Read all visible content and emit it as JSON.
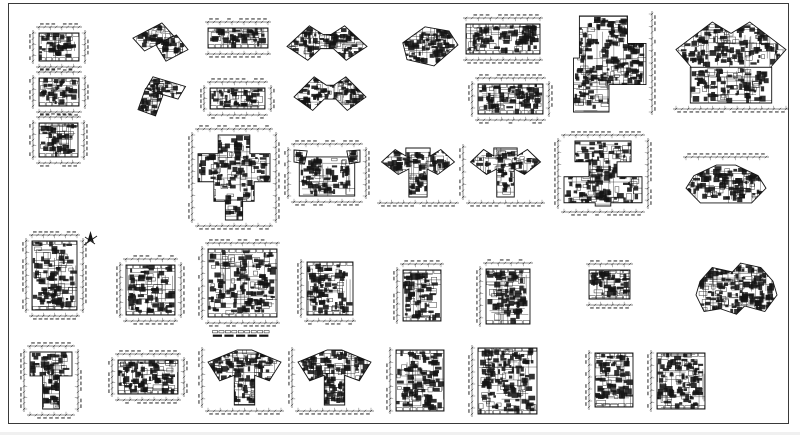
{
  "sheet": {
    "bg": "#ffffff",
    "ink": "#141414",
    "frame_color": "#3a3a3a",
    "frame": {
      "x": 8,
      "y": 3,
      "w": 781,
      "h": 421
    }
  },
  "north_arrow": {
    "x": 82,
    "y": 231,
    "size": 17
  },
  "caption_strip": {
    "x": 212,
    "y": 325,
    "w": 58,
    "row1_segments": 9,
    "row2_segments": 5
  },
  "plans": [
    {
      "id": "p01",
      "x": 30,
      "y": 24,
      "w": 58,
      "h": 46,
      "shape": "slab",
      "dims": "tblr",
      "density": 1.15
    },
    {
      "id": "p02",
      "x": 30,
      "y": 69,
      "w": 58,
      "h": 46,
      "shape": "slab",
      "dims": "tblr",
      "density": 1.15
    },
    {
      "id": "p03",
      "x": 30,
      "y": 114,
      "w": 57,
      "h": 52,
      "shape": "slab",
      "dims": "tblr",
      "density": 1.1
    },
    {
      "id": "p04",
      "x": 128,
      "y": 20,
      "w": 62,
      "h": 50,
      "shape": "lshape",
      "dims": "",
      "density": 1.25
    },
    {
      "id": "p05",
      "x": 136,
      "y": 74,
      "w": 54,
      "h": 46,
      "shape": "lshape2",
      "dims": "",
      "density": 1.25
    },
    {
      "id": "p06",
      "x": 206,
      "y": 19,
      "w": 64,
      "h": 38,
      "shape": "slab",
      "dims": "tb",
      "density": 1.2
    },
    {
      "id": "p07",
      "x": 201,
      "y": 79,
      "w": 73,
      "h": 39,
      "shape": "slab",
      "dims": "tblr",
      "density": 1.2
    },
    {
      "id": "p08",
      "x": 285,
      "y": 23,
      "w": 84,
      "h": 47,
      "shape": "butterfly",
      "dims": "",
      "density": 1.3
    },
    {
      "id": "p09",
      "x": 292,
      "y": 74,
      "w": 76,
      "h": 46,
      "shape": "butterfly",
      "dims": "",
      "density": 1.3
    },
    {
      "id": "p10",
      "x": 396,
      "y": 24,
      "w": 64,
      "h": 46,
      "shape": "angled",
      "dims": "",
      "density": 1.3
    },
    {
      "id": "p11",
      "x": 464,
      "y": 15,
      "w": 78,
      "h": 48,
      "shape": "slab",
      "dims": "tb",
      "density": 1.2
    },
    {
      "id": "p12",
      "x": 469,
      "y": 75,
      "w": 83,
      "h": 48,
      "shape": "slab",
      "dims": "tblr",
      "density": 1.2
    },
    {
      "id": "p13",
      "x": 570,
      "y": 12,
      "w": 85,
      "h": 102,
      "shape": "zshape",
      "dims": "r",
      "density": 1.15
    },
    {
      "id": "p14",
      "x": 674,
      "y": 20,
      "w": 114,
      "h": 92,
      "shape": "bigwing",
      "dims": "b",
      "density": 1.0
    },
    {
      "id": "p15",
      "x": 189,
      "y": 126,
      "w": 90,
      "h": 103,
      "shape": "cross",
      "dims": "tblr",
      "density": 1.05
    },
    {
      "id": "p16",
      "x": 285,
      "y": 141,
      "w": 84,
      "h": 64,
      "shape": "rectwing",
      "dims": "tblr",
      "density": 1.1
    },
    {
      "id": "p17",
      "x": 378,
      "y": 145,
      "w": 80,
      "h": 61,
      "shape": "teewing",
      "dims": "b",
      "density": 1.2
    },
    {
      "id": "p18",
      "x": 460,
      "y": 145,
      "w": 84,
      "h": 61,
      "shape": "teewing",
      "dims": "lb",
      "density": 1.2
    },
    {
      "id": "p19",
      "x": 555,
      "y": 132,
      "w": 96,
      "h": 83,
      "shape": "teebig",
      "dims": "tblr",
      "density": 1.0
    },
    {
      "id": "p20",
      "x": 684,
      "y": 154,
      "w": 84,
      "h": 53,
      "shape": "hex",
      "dims": "t",
      "density": 1.2
    },
    {
      "id": "p21",
      "x": 23,
      "y": 232,
      "w": 63,
      "h": 87,
      "shape": "slab",
      "dims": "tblr",
      "density": 1.0
    },
    {
      "id": "p22",
      "x": 117,
      "y": 256,
      "w": 67,
      "h": 68,
      "shape": "slab",
      "dims": "tblr",
      "density": 1.0
    },
    {
      "id": "p23",
      "x": 199,
      "y": 240,
      "w": 80,
      "h": 86,
      "shape": "slab",
      "dims": "tbl",
      "density": 1.0
    },
    {
      "id": "p24",
      "x": 298,
      "y": 260,
      "w": 57,
      "h": 64,
      "shape": "slab",
      "dims": "lb",
      "density": 1.1
    },
    {
      "id": "p25",
      "x": 394,
      "y": 261,
      "w": 49,
      "h": 62,
      "shape": "slab",
      "dims": "lt",
      "density": 1.1
    },
    {
      "id": "p26",
      "x": 477,
      "y": 260,
      "w": 55,
      "h": 66,
      "shape": "slab",
      "dims": "lt",
      "density": 1.1
    },
    {
      "id": "p27",
      "x": 587,
      "y": 261,
      "w": 45,
      "h": 47,
      "shape": "slab",
      "dims": "tb",
      "density": 1.5
    },
    {
      "id": "p28",
      "x": 694,
      "y": 260,
      "w": 85,
      "h": 59,
      "shape": "cluster",
      "dims": "",
      "density": 1.3
    },
    {
      "id": "p29",
      "x": 21,
      "y": 343,
      "w": 60,
      "h": 75,
      "shape": "tee",
      "dims": "tblr",
      "density": 1.25
    },
    {
      "id": "p30",
      "x": 109,
      "y": 351,
      "w": 78,
      "h": 52,
      "shape": "slab",
      "dims": "tblr",
      "density": 1.25
    },
    {
      "id": "p31",
      "x": 199,
      "y": 348,
      "w": 84,
      "h": 66,
      "shape": "fan",
      "dims": "lb",
      "density": 1.25
    },
    {
      "id": "p32",
      "x": 289,
      "y": 348,
      "w": 84,
      "h": 66,
      "shape": "fan",
      "dims": "lb",
      "density": 1.25
    },
    {
      "id": "p33",
      "x": 387,
      "y": 348,
      "w": 59,
      "h": 65,
      "shape": "slab",
      "dims": "l",
      "density": 1.15
    },
    {
      "id": "p34",
      "x": 469,
      "y": 346,
      "w": 70,
      "h": 70,
      "shape": "slab",
      "dims": "l",
      "density": 1.1
    },
    {
      "id": "p35",
      "x": 586,
      "y": 351,
      "w": 49,
      "h": 58,
      "shape": "slab",
      "dims": "l",
      "density": 1.2
    },
    {
      "id": "p36",
      "x": 648,
      "y": 351,
      "w": 59,
      "h": 60,
      "shape": "slab",
      "dims": "l",
      "density": 1.2
    }
  ]
}
